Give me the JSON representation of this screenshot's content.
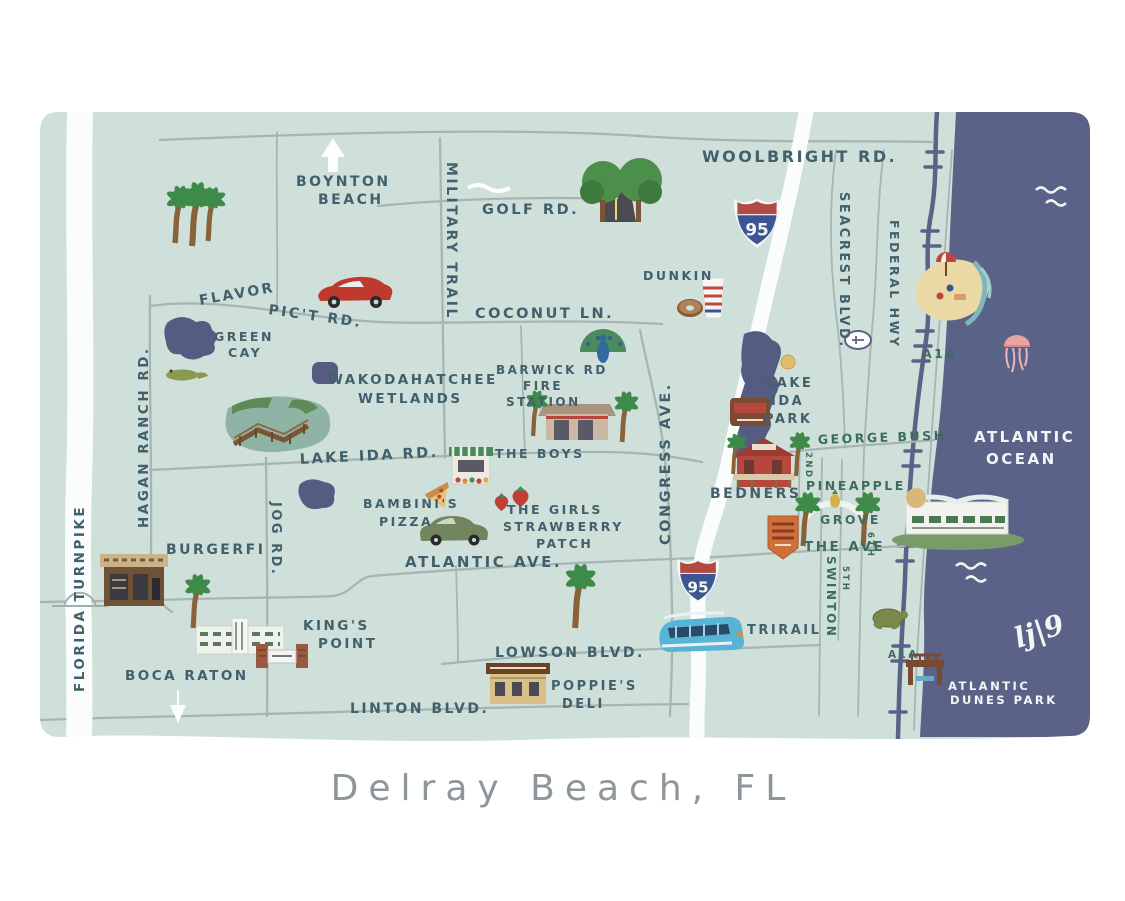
{
  "title": "Delray Beach, FL",
  "signature": "lj|9",
  "interstate": {
    "label": "95"
  },
  "roads": {
    "woolbright": "WOOLBRIGHT RD.",
    "military_trail": "MILITARY TRAIL",
    "golf": "GOLF RD.",
    "flavor_pict": [
      "FLAVOR",
      "PIC'T RD."
    ],
    "coconut": "COCONUT LN.",
    "hagan_ranch": "HAGAN RANCH RD.",
    "lake_ida": "LAKE IDA RD.",
    "jog": "JOG RD.",
    "atlantic": "ATLANTIC AVE.",
    "congress": "CONGRESS AVE.",
    "lowson": "LOWSON BLVD.",
    "linton": "LINTON  BLVD.",
    "seacrest": "SEACREST BLVD.",
    "federal": "FEDERAL HWY",
    "swinton": "SWINTON",
    "george_bush": "GEORGE BUSH",
    "the_ave": "THE AVE",
    "second": "2ND",
    "fifth": "5TH",
    "sixth": "6TH",
    "a1a_north": "A1A",
    "a1a_south": "A1A",
    "turnpike": "FLORIDA TURNPIKE"
  },
  "places": {
    "boynton": [
      "BOYNTON",
      "BEACH"
    ],
    "green_cay": [
      "GREEN",
      "CAY"
    ],
    "wakodahatchee": [
      "WAKODAHATCHEE",
      "WETLANDS"
    ],
    "barwick": [
      "BARWICK RD",
      "FIRE",
      "STATION"
    ],
    "dunkin": "DUNKIN",
    "the_boys": "THE BOYS",
    "bambinis": [
      "BAMBINI'S",
      "PIZZA"
    ],
    "strawberry": [
      "THE GIRLS",
      "STRAWBERRY",
      "PATCH"
    ],
    "burgerfi": "BURGERFI",
    "kings_point": [
      "KING'S",
      "POINT"
    ],
    "boca": "BOCA RATON",
    "poppies": [
      "POPPIE'S",
      "DELI"
    ],
    "trirail": "TRIRAIL",
    "lake_ida_park": [
      "LAKE",
      "IDA",
      "PARK"
    ],
    "bedners": "BEDNERS",
    "pineapple_grove": [
      "PINEAPPLE",
      "GROVE"
    ],
    "ocean": [
      "ATLANTIC",
      "OCEAN"
    ],
    "dunes": [
      "ATLANTIC",
      "DUNES PARK"
    ]
  },
  "colors": {
    "land": "#cfe0db",
    "ocean": "#5b6287",
    "lake": "#545c82",
    "road_gray": "#a7b5b2",
    "road_white": "#fbfdfc",
    "label_slate": "#42606c",
    "label_green": "#3e6b60",
    "white_text": "#f3f6f6",
    "title_gray": "#8d969a",
    "shield_red": "#b04a42",
    "shield_blue": "#3a5590"
  }
}
